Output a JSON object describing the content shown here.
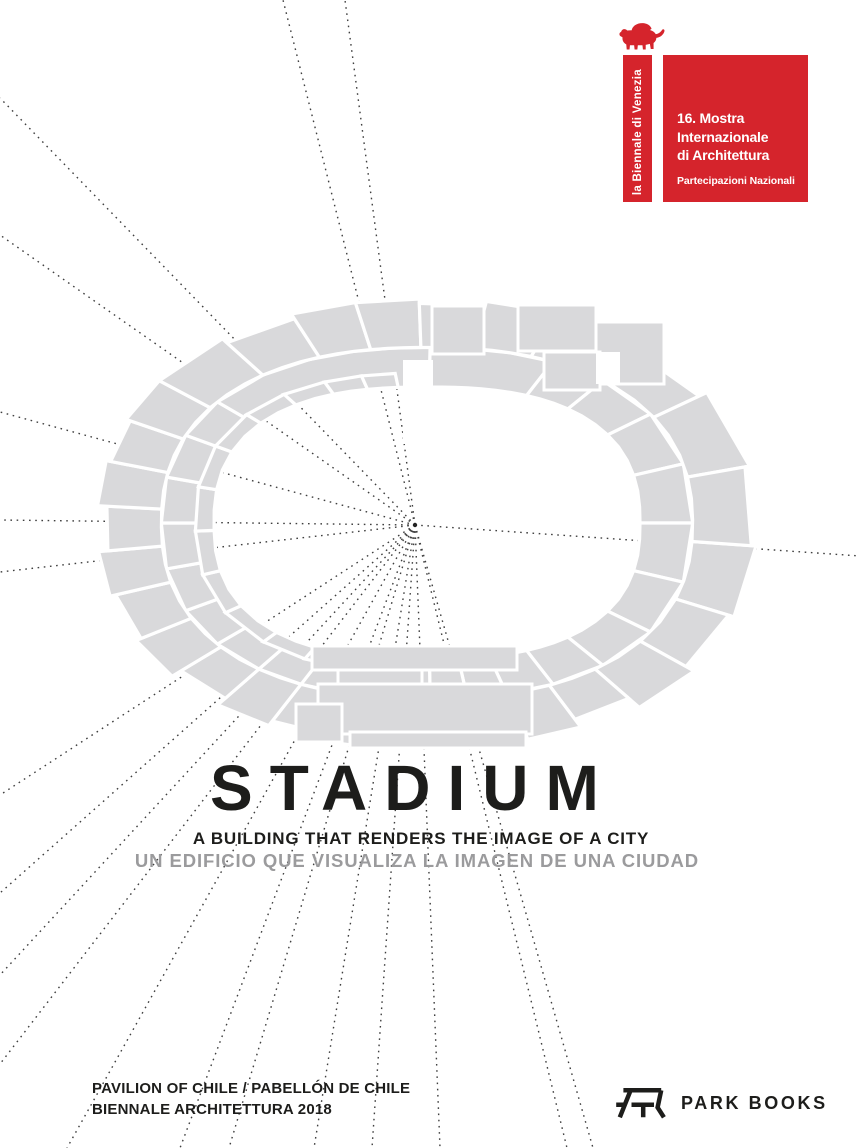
{
  "page": {
    "width": 860,
    "height": 1148,
    "background": "#ffffff"
  },
  "colors": {
    "red": "#d5242c",
    "ring": "#d9d9db",
    "gap": "#ffffff",
    "ray": "#3f3f3f",
    "title": "#1d1d1b",
    "subtitle_gray": "#9b9b9d"
  },
  "biennale": {
    "vertical_label": "la Biennale di Venezia",
    "line1": "16. Mostra",
    "line2": "Internazionale",
    "line3": "di Architettura",
    "sub": "Partecipazioni Nazionali"
  },
  "title_block": {
    "title": "STADIUM",
    "subtitle_en": "A BUILDING THAT RENDERS THE IMAGE OF A CITY",
    "subtitle_es": "UN EDIFICIO QUE VISUALIZA LA IMAGEN DE UNA CIUDAD"
  },
  "footer": {
    "line1": "PAVILION OF CHILE / PABELLÓN DE CHILE",
    "line2": "BIENNALE ARCHITETTURA 2018",
    "publisher": "PARK BOOKS"
  },
  "rays": {
    "origin": [
      415,
      525
    ],
    "width": 1.4,
    "dash": "1.6 4.6",
    "endpoints": [
      [
        0,
        98
      ],
      [
        0,
        235
      ],
      [
        0,
        412
      ],
      [
        0,
        520
      ],
      [
        0,
        572
      ],
      [
        283,
        0
      ],
      [
        345,
        0
      ],
      [
        860,
        556
      ],
      [
        593,
        1148
      ],
      [
        567,
        1148
      ],
      [
        440,
        1148
      ],
      [
        372,
        1148
      ],
      [
        314,
        1148
      ],
      [
        229,
        1148
      ],
      [
        180,
        1148
      ],
      [
        67,
        1148
      ],
      [
        0,
        1064
      ],
      [
        0,
        975
      ],
      [
        0,
        893
      ],
      [
        0,
        795
      ]
    ]
  },
  "stadium": {
    "cx": 427,
    "cy": 523,
    "inner": {
      "a": 213,
      "b": 136,
      "n": 2.5
    },
    "outer": {
      "a": 330,
      "b": 224,
      "n": 2.2
    },
    "layers": [
      {
        "t0": 0,
        "t1": 0.45,
        "bounds": [
          95,
          106,
          117,
          128,
          139,
          150,
          160,
          170,
          180,
          190,
          200,
          210,
          271,
          308,
          321,
          334,
          347,
          360,
          373,
          386,
          399,
          412,
          425,
          437,
          449,
          455
        ]
      },
      {
        "t0": 0,
        "t1": 0.16,
        "bounds": [
          96,
          108,
          120,
          132,
          144,
          156,
          167,
          178,
          189,
          200,
          211,
          222,
          234,
          246,
          258
        ]
      },
      {
        "t0": 0.45,
        "t1": 1,
        "bounds": [
          4,
          17,
          29,
          41,
          53,
          65,
          78,
          91,
          104,
          117,
          128,
          139,
          149,
          158,
          167,
          175,
          183,
          191,
          199,
          208,
          222,
          237,
          252,
          268,
          285,
          302,
          318,
          335,
          350,
          364
        ],
        "tout": [
          1,
          0.95,
          1.04,
          0.9,
          1,
          0.96,
          1,
          0.9,
          1.03,
          0.94,
          1,
          0.9,
          1,
          0.95,
          1,
          0.92,
          1,
          0.96,
          1,
          1,
          0.94,
          1,
          1,
          0.95,
          1,
          1.05,
          0.92,
          1,
          0.96
        ]
      }
    ],
    "overlay_blocks": [
      [
        518,
        305,
        78,
        46
      ],
      [
        596,
        322,
        68,
        62
      ],
      [
        544,
        352,
        56,
        38
      ],
      [
        432,
        306,
        52,
        48
      ]
    ],
    "notches": [
      [
        403,
        360,
        30,
        84
      ],
      [
        433,
        391,
        44,
        52
      ],
      [
        596,
        352,
        24,
        32
      ]
    ],
    "annex": [
      [
        312,
        646,
        205,
        24
      ],
      [
        338,
        670,
        84,
        26
      ],
      [
        318,
        684,
        214,
        50
      ],
      [
        296,
        704,
        46,
        38
      ],
      [
        350,
        732,
        176,
        16
      ]
    ]
  }
}
